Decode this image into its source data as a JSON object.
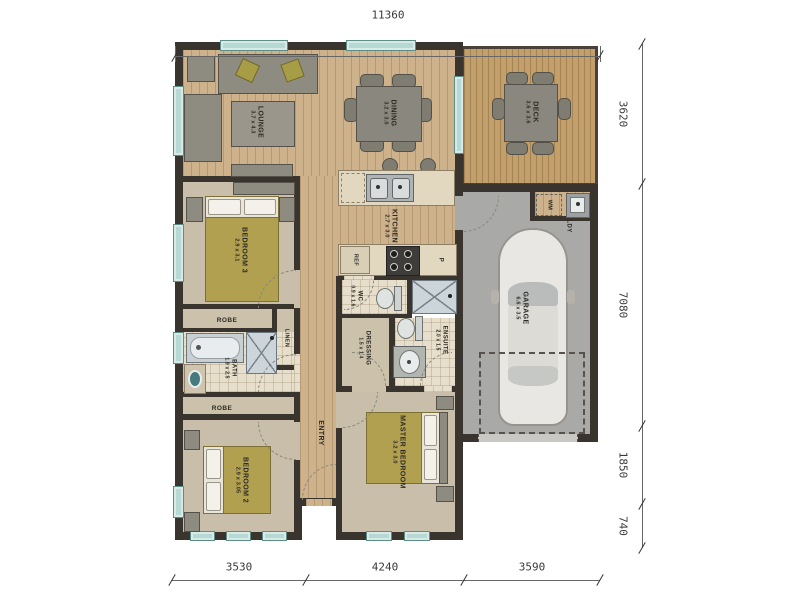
{
  "dimensions": {
    "top": "11360",
    "right": [
      "3620",
      "7080",
      "1850",
      "740"
    ],
    "bottom": [
      "3530",
      "4240",
      "3590"
    ]
  },
  "rooms": {
    "lounge": {
      "name": "LOUNGE",
      "size": "3.7 x 4.3"
    },
    "dining": {
      "name": "DINING",
      "size": "3.2 x 3.0"
    },
    "deck": {
      "name": "DECK",
      "size": "3.6 x 3.6"
    },
    "kitchen": {
      "name": "KITCHEN",
      "size": "2.7 x 3.0"
    },
    "bedroom3": {
      "name": "BEDROOM 3",
      "size": "2.9 x 3.1"
    },
    "bedroom2": {
      "name": "BEDROOM 2",
      "size": "2.9 x 3.05"
    },
    "master": {
      "name": "MASTER BEDROOM",
      "size": "3.2 x 3.0"
    },
    "garage": {
      "name": "GARAGE",
      "size": "6.6 x 3.5"
    },
    "ensuite": {
      "name": "ENSUITE",
      "size": "2.0 x 1.5"
    },
    "dressing": {
      "name": "DRESSING",
      "size": "1.5 x 1.4"
    },
    "bath": {
      "name": "BATH",
      "size": "1.9 x 2.5"
    },
    "wc": {
      "name": "WC",
      "size": "0.9 x 1.6"
    },
    "entry": {
      "name": "ENTRY"
    }
  },
  "fixtures": {
    "robe": "ROBE",
    "linen": "LINEN",
    "laundry": "LDY",
    "fridge": "REF",
    "pantry": "P",
    "washing_machine": "WM"
  },
  "colors": {
    "wall": "#39342e",
    "wood_floor": "#cdb28c",
    "deck_floor": "#c29f6b",
    "carpet": "#c8bea9",
    "tile": "#e7dfcb",
    "garage_floor": "#a9a9a7",
    "window": "#b7d9d3",
    "bed_cover": "#b1a050"
  }
}
